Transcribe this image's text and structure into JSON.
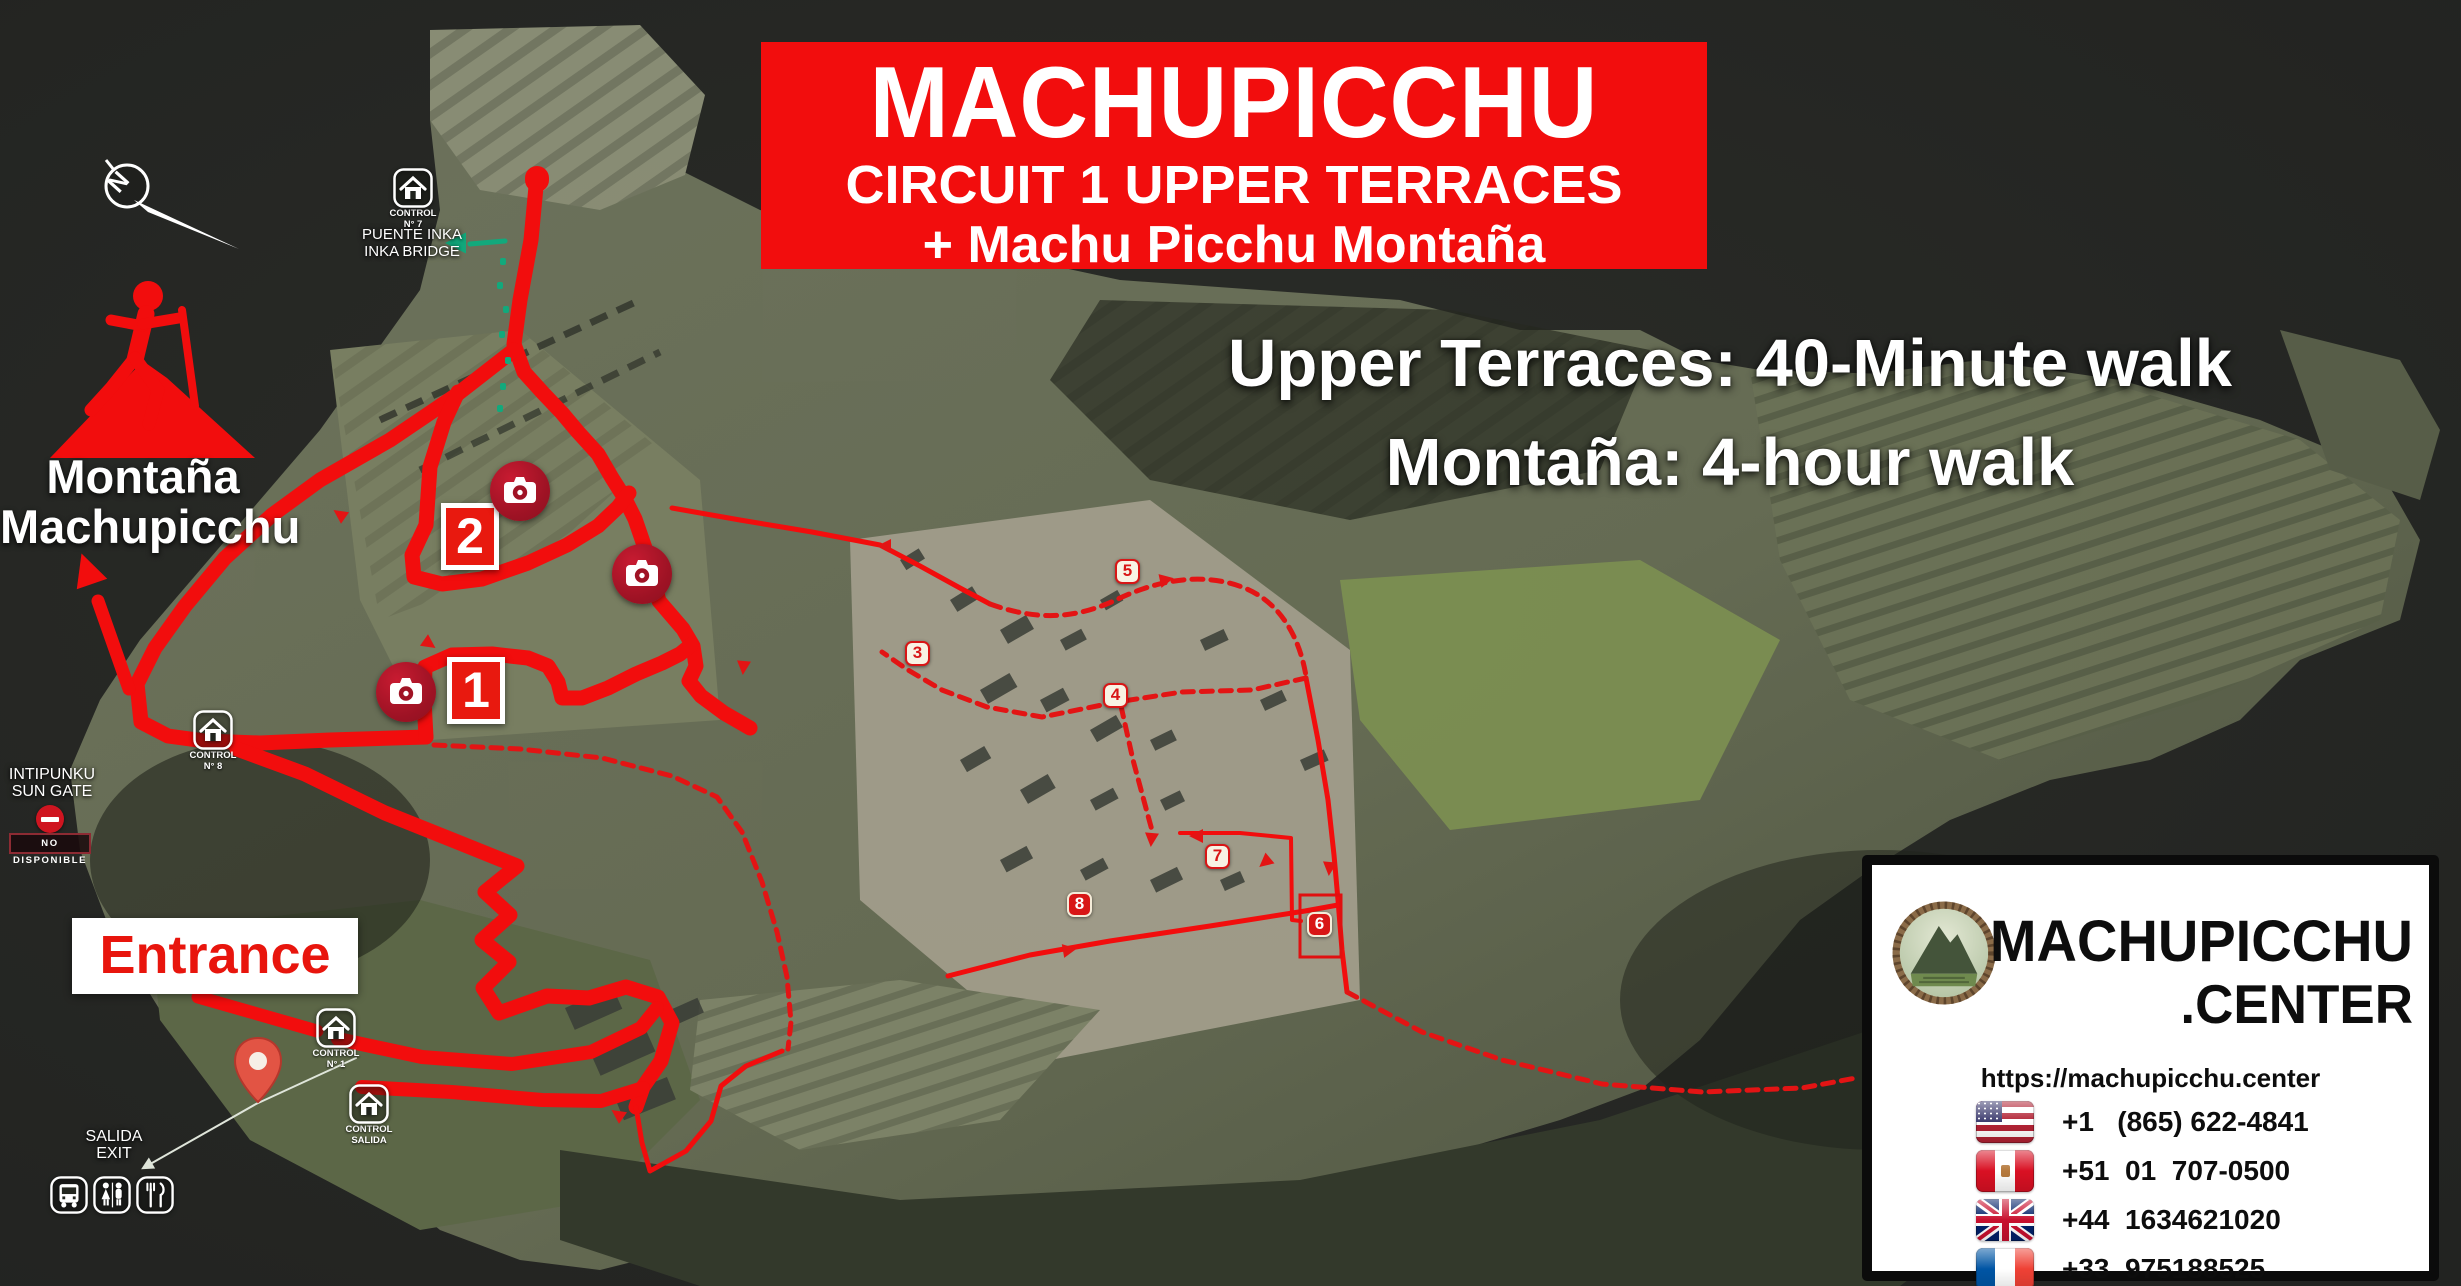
{
  "banner": {
    "title": "MACHUPICCHU",
    "subtitle": "CIRCUIT 1 UPPER TERRACES",
    "subtitle2": "+ Machu Picchu Montaña",
    "bg_color": "#f20d0d"
  },
  "walk_info": {
    "line1": "Upper Terraces: 40-Minute walk",
    "line2": "Montaña: 4-hour walk"
  },
  "montana": {
    "line1": "Montaña",
    "line2": "Machupicchu"
  },
  "labels": {
    "puente_line1": "PUENTE INKA",
    "puente_line2": "INKA BRIDGE",
    "intipunku_line1": "INTIPUNKU",
    "intipunku_line2": "SUN GATE",
    "no_disponible": "NO DISPONIBLE",
    "salida_line1": "SALIDA",
    "salida_line2": "EXIT",
    "entrance": "Entrance"
  },
  "info_card": {
    "brand_line1": "MACHUPICCHU",
    "brand_line2": ".CENTER",
    "url": "https://machupicchu.center",
    "phones": [
      {
        "flag": "us",
        "number": "+1   (865) 622-4841"
      },
      {
        "flag": "pe",
        "number": "+51  01  707-0500"
      },
      {
        "flag": "gb",
        "number": "+44  1634621020"
      },
      {
        "flag": "fr",
        "number": "+33  975188525"
      }
    ]
  },
  "colors": {
    "route_red": "#f20d0d",
    "dashed_red": "#e31414",
    "teal": "#12a97c",
    "leader": "#dfe5da",
    "marker_red": "#d81616"
  },
  "map": {
    "compass_n": "N",
    "controls": [
      {
        "line1": "CONTROL",
        "line2": "N° 7",
        "x": 393,
        "y": 168
      },
      {
        "line1": "CONTROL",
        "line2": "N° 8",
        "x": 193,
        "y": 710
      },
      {
        "line1": "CONTROL",
        "line2": "N° 1",
        "x": 316,
        "y": 1008
      },
      {
        "line1": "CONTROL",
        "line2": "SALIDA",
        "x": 349,
        "y": 1084
      }
    ],
    "badges": [
      {
        "label": "2",
        "x": 441,
        "y": 503
      },
      {
        "label": "1",
        "x": 447,
        "y": 657
      }
    ],
    "cameras": [
      {
        "x": 490,
        "y": 461
      },
      {
        "x": 612,
        "y": 544
      },
      {
        "x": 376,
        "y": 662
      }
    ],
    "waypoints": [
      {
        "label": "3",
        "x": 905,
        "y": 641,
        "style": "light"
      },
      {
        "label": "4",
        "x": 1103,
        "y": 683,
        "style": "light"
      },
      {
        "label": "5",
        "x": 1115,
        "y": 559,
        "style": "light"
      },
      {
        "label": "6",
        "x": 1307,
        "y": 912,
        "style": "filled"
      },
      {
        "label": "7",
        "x": 1205,
        "y": 844,
        "style": "light"
      },
      {
        "label": "8",
        "x": 1067,
        "y": 892,
        "style": "filled"
      }
    ],
    "highlight_rect": {
      "x": 1300,
      "y": 895,
      "w": 41,
      "h": 62
    },
    "routes": [
      {
        "name": "bridge-start-blob",
        "d": "M537,178 L537,180",
        "w": 24
      },
      {
        "name": "bridge-descent-east-side",
        "d": "M537,176 L531,240 L520,300 L514,344 L524,372 L543,393 L562,413 L578,432 L598,454 L612,478 L624,497 L635,519 L646,551 L659,601 L683,629 L693,646 L696,666 L689,681 L701,696 L724,713 L750,728",
        "w": 15
      },
      {
        "name": "upper-diagonal-to-sungate-corner",
        "d": "M514,350 L455,396 L390,440 L320,480 L272,515 L225,558 L185,606 L155,648 L137,684 L141,722 L168,736 L205,741 L260,743 L330,740 L426,737",
        "w": 15
      },
      {
        "name": "lower-terrace-loop",
        "d": "M426,737 L424,700 L425,667 L452,655 L492,654 L528,658 L548,666 L558,682 L562,698 L582,698 L608,688 L636,674 L662,663 L680,654 L691,645",
        "w": 15
      },
      {
        "name": "upper-terrace-loop",
        "d": "M458,392 L444,422 L430,467 L426,525 L412,555 L414,577 L442,584 L482,579 L528,563 L567,545 L598,526 L618,507 L629,493",
        "w": 15
      },
      {
        "name": "entrance-zigzag-path",
        "d": "M237,749 L305,774 L385,813 L455,841 L517,866 L485,892 L510,915 L482,940 L509,962 L483,988 L499,1013 L547,996 L589,998 L626,987 L658,997 L672,1023 L661,1061 L643,1087 L636,1107",
        "w": 15
      },
      {
        "name": "entrance-connector",
        "d": "M198,997 L317,1031",
        "w": 13
      },
      {
        "name": "entry-path-1",
        "d": "M338,1039 L422,1057 L512,1064 L591,1052 L641,1028 L657,1008",
        "w": 14
      },
      {
        "name": "entry-path-2",
        "d": "M362,1087 L452,1092 L542,1100 L601,1101 L643,1088",
        "w": 14
      },
      {
        "name": "montana-arrow-shaft",
        "d": "M129,689 L98,601",
        "w": 13
      },
      {
        "name": "link-to-ruins",
        "d": "M672,508 L740,520 L812,532 L880,545 L920,566 L960,588 L990,604",
        "w": 5
      },
      {
        "name": "ruins-east-side",
        "d": "M1306,678 L1318,740 L1328,800 L1334,855 L1338,900 L1342,950 L1347,992",
        "w": 5
      },
      {
        "name": "ruins-lower-cross",
        "d": "M948,976 L1030,955 L1110,941 L1210,926 L1305,911 L1338,905",
        "w": 5
      },
      {
        "name": "ruins-grass-line",
        "d": "M1180,833 L1240,833 L1291,838 L1292,920 L1301,921",
        "w": 4
      },
      {
        "name": "exit-trail",
        "d": "M636,1107 L642,1143 L650,1171 L686,1151 L711,1121 L721,1086 L746,1066 L782,1051",
        "w": 5
      },
      {
        "name": "circuit-dashed-north",
        "d": "M990,604 C1040,622 1078,618 1118,599 C1158,580 1202,572 1242,587 C1282,602 1300,640 1306,676",
        "w": 5,
        "dash": true
      },
      {
        "name": "circuit-dashed-return",
        "d": "M1306,678 L1252,690 L1182,692 L1117,702 L1042,717 L987,707 L942,690 L908,670 L882,652",
        "w": 5,
        "dash": true
      },
      {
        "name": "circuit-dashed-spur",
        "d": "M1121,706 L1133,760 L1147,812 L1153,834",
        "w": 5,
        "dash": true
      },
      {
        "name": "terrace-bottom-dashed",
        "d": "M434,745 L520,749 L602,758 L672,776 L717,797 L742,832 L762,882 L777,932 L787,977 L791,1022 L788,1049",
        "w": 5,
        "dash": true
      },
      {
        "name": "southeast-dashed",
        "d": "M1347,992 L1422,1032 L1502,1060 L1602,1084 L1702,1092 L1802,1088 L1856,1078",
        "w": 5,
        "dash": true
      },
      {
        "name": "salida-leader-line",
        "d": "M152,1163 L256,1104 L356,1058",
        "w": 2,
        "c": "#dfe5da"
      },
      {
        "name": "inka-bridge-teal-arrow",
        "d": "M505,241 L470,244",
        "w": 5,
        "c": "#12a97c"
      }
    ],
    "arrows": [
      {
        "x": 92,
        "y": 584,
        "r": -109,
        "s": 2.3,
        "c": "#f20d0d"
      },
      {
        "x": 466,
        "y": 243,
        "r": 180,
        "s": 1.5,
        "c": "#12a97c"
      },
      {
        "x": 152,
        "y": 1163,
        "r": 150,
        "s": 0.9,
        "c": "#dfe5da"
      },
      {
        "x": 891,
        "y": 546,
        "r": 180,
        "s": 1
      },
      {
        "x": 497,
        "y": 475,
        "r": 50,
        "s": 1
      },
      {
        "x": 424,
        "y": 640,
        "r": 35,
        "s": 1
      },
      {
        "x": 744,
        "y": 661,
        "r": 95,
        "s": 1
      },
      {
        "x": 1160,
        "y": 581,
        "r": -12,
        "s": 1
      },
      {
        "x": 1203,
        "y": 836,
        "r": 180,
        "s": 1
      },
      {
        "x": 1270,
        "y": 858,
        "r": 140,
        "s": 1
      },
      {
        "x": 1330,
        "y": 862,
        "r": 95,
        "s": 1
      },
      {
        "x": 1063,
        "y": 951,
        "r": -10,
        "s": 1
      },
      {
        "x": 623,
        "y": 1118,
        "r": 215,
        "s": 1
      },
      {
        "x": 345,
        "y": 518,
        "r": 215,
        "s": 1
      },
      {
        "x": 1152,
        "y": 833,
        "r": 95,
        "s": 1
      }
    ],
    "teal_dots": [
      [
        500,
        258
      ],
      [
        497,
        282
      ],
      [
        503,
        306
      ],
      [
        499,
        331
      ],
      [
        505,
        357
      ],
      [
        500,
        383
      ],
      [
        497,
        405
      ]
    ],
    "buildings": [
      [
        950,
        600,
        26,
        14,
        -32
      ],
      [
        1000,
        630,
        30,
        16,
        -30
      ],
      [
        1060,
        640,
        24,
        12,
        -28
      ],
      [
        1100,
        600,
        20,
        12,
        -30
      ],
      [
        980,
        690,
        34,
        16,
        -30
      ],
      [
        1040,
        700,
        26,
        14,
        -28
      ],
      [
        1090,
        730,
        30,
        14,
        -30
      ],
      [
        1150,
        740,
        24,
        12,
        -26
      ],
      [
        960,
        760,
        28,
        14,
        -30
      ],
      [
        1020,
        790,
        32,
        16,
        -30
      ],
      [
        1090,
        800,
        26,
        12,
        -28
      ],
      [
        1160,
        800,
        22,
        12,
        -26
      ],
      [
        1000,
        860,
        30,
        14,
        -28
      ],
      [
        1080,
        870,
        26,
        12,
        -28
      ],
      [
        1150,
        880,
        30,
        14,
        -26
      ],
      [
        1220,
        880,
        22,
        12,
        -24
      ],
      [
        900,
        560,
        22,
        12,
        -32
      ],
      [
        1200,
        640,
        26,
        12,
        -25
      ],
      [
        1260,
        700,
        24,
        12,
        -25
      ],
      [
        1300,
        760,
        26,
        12,
        -24
      ],
      [
        565,
        1008,
        52,
        24,
        -24
      ],
      [
        590,
        1052,
        60,
        26,
        -24
      ],
      [
        615,
        1098,
        56,
        24,
        -22
      ],
      [
        670,
        1010,
        30,
        16,
        -24
      ]
    ],
    "facilities": [
      "bus",
      "restroom",
      "restaurant"
    ]
  }
}
